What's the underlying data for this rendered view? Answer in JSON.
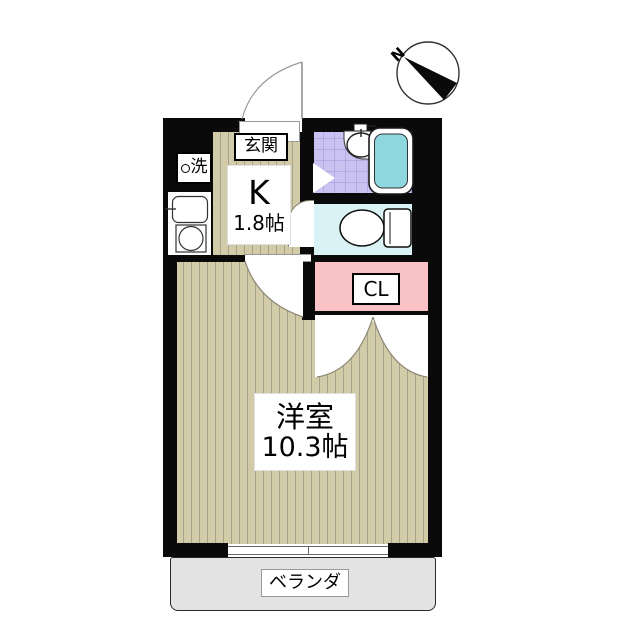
{
  "compass": {
    "north_label": "N"
  },
  "rooms": {
    "genkan": {
      "label": "玄関"
    },
    "kitchen": {
      "label": "K",
      "size": "1.8帖"
    },
    "washer": {
      "label": "洗"
    },
    "closet": {
      "label": "CL"
    },
    "western_room": {
      "label": "洋室",
      "size": "10.3帖"
    },
    "veranda": {
      "label": "ベランダ"
    }
  },
  "icons": {
    "compass": "north-arrow",
    "bathtub": "bathtub-top-view",
    "washbasin": "oval-basin",
    "toilet": "toilet-top-view",
    "kitchen_sink": "sink-top-view",
    "stove": "single-burner",
    "washer_circle": "circle-marker"
  },
  "colors": {
    "wall": "#0a0a0a",
    "floor": "#d2cba7",
    "floor_line": "#a9a28a",
    "bath_tile": "#cac2f0",
    "bath_tile_line": "#b3aae6",
    "tub": "#8ed7de",
    "toilet_floor": "#d9f2f5",
    "closet": "#f9c2c6",
    "veranda": "#e3e3e3"
  }
}
